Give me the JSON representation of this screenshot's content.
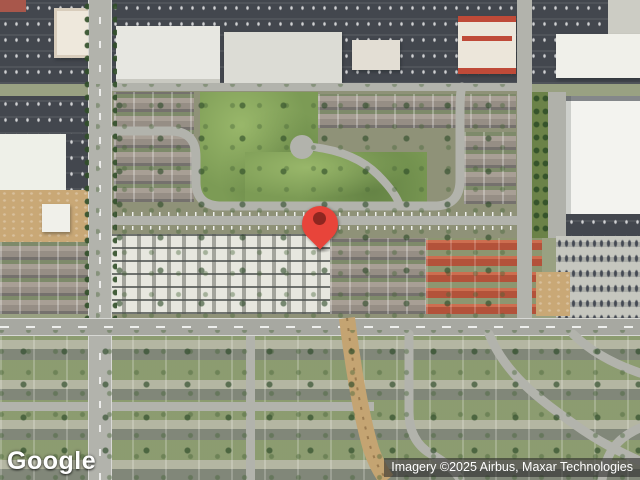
{
  "map": {
    "view_type": "satellite",
    "logo": {
      "text": "Google"
    },
    "attribution": {
      "text": "Imagery ©2025 Airbus, Maxar Technologies"
    },
    "marker": {
      "kind": "red-location-pin",
      "color": "#E8443A",
      "inner_color": "#8E2620"
    },
    "palette": {
      "road": "#B2B3AC",
      "main_road": "#A7A8A1",
      "asphalt_lot": "#43474E",
      "park_green": "#7C9B55",
      "white_roof": "#F3F3EF",
      "red_tile_roof": "#B3523A",
      "dirt_tan": "#C9A876",
      "railroad_tan": "#C4A472"
    }
  }
}
